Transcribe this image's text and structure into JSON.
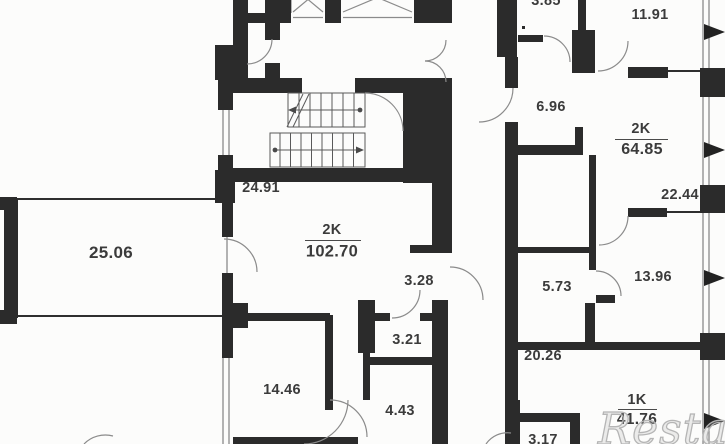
{
  "watermark": "Restate",
  "plan": {
    "rooms": [
      {
        "name": "room-25-06",
        "label": "25.06"
      },
      {
        "name": "room-24-91",
        "label": "24.91"
      },
      {
        "name": "room-3-28",
        "label": "3.28"
      },
      {
        "name": "room-3-21",
        "label": "3.21"
      },
      {
        "name": "room-14-46",
        "label": "14.46"
      },
      {
        "name": "room-4-43",
        "label": "4.43"
      },
      {
        "name": "room-3-85",
        "label": "3.85"
      },
      {
        "name": "room-11-91",
        "label": "11.91"
      },
      {
        "name": "room-6-96",
        "label": "6.96"
      },
      {
        "name": "room-22-44",
        "label": "22.44"
      },
      {
        "name": "room-13-96",
        "label": "13.96"
      },
      {
        "name": "room-5-73",
        "label": "5.73"
      },
      {
        "name": "room-20-26",
        "label": "20.26"
      },
      {
        "name": "room-3-17",
        "label": "3.17"
      }
    ],
    "apartments": [
      {
        "type": "2K",
        "area": "102.70"
      },
      {
        "type": "2K",
        "area": "64.85"
      },
      {
        "type": "1K",
        "area": "41.76"
      }
    ]
  }
}
